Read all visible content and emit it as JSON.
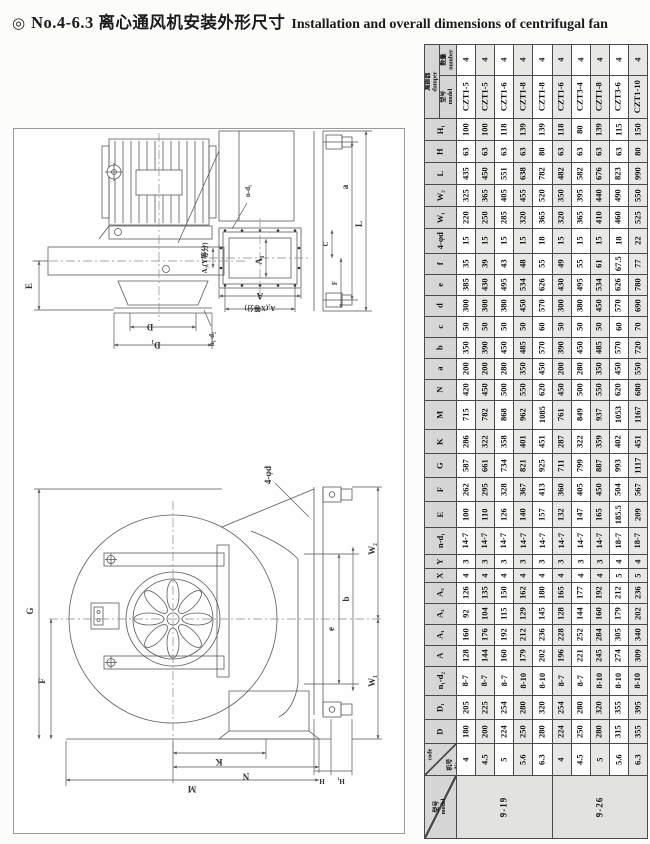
{
  "title": {
    "bullet": "◎",
    "zh": "No.4-6.3 离心通风机安装外形尺寸",
    "en": "Installation and overall dimensions of centrifugal fan"
  },
  "drawings": {
    "top": {
      "E": "E",
      "D": "D",
      "D1": "D₁",
      "n1d2": "n₁-d₂",
      "A1": "A₁",
      "A": "A",
      "A2x": "A₂(X等分)",
      "A3y": "A₃(Y等分)",
      "nd1": "n-d₁",
      "a": "a",
      "L": "L",
      "C": "C",
      "F": "F"
    },
    "bottom": {
      "phid": "4-φd",
      "G": "G",
      "F": "F",
      "W2": "W₂",
      "W1": "W₁",
      "e": "e",
      "b": "b",
      "K": "K",
      "N": "N",
      "M": "M",
      "H": "H",
      "H1": "H₁"
    }
  },
  "table": {
    "damper_group": "减振器\ndamper",
    "bands": [
      {
        "type": "damper-number",
        "label": "数量\nnumber",
        "h": 30,
        "cells": [
          "4",
          "4",
          "4",
          "4",
          "4",
          "4",
          "4",
          "4",
          "4",
          "4"
        ]
      },
      {
        "type": "damper-model",
        "label": "型号\nmodel",
        "h": 42,
        "cells": [
          "CZT1-5",
          "CZT1-5",
          "CZT1-6",
          "CZT1-8",
          "CZT1-8",
          "CZT1-6",
          "CZT3-4",
          "CZT1-8",
          "CZT3-6",
          "CZT1-10"
        ]
      },
      {
        "label": "H₁",
        "h": 21,
        "cells": [
          "100",
          "100",
          "118",
          "139",
          "139",
          "118",
          "80",
          "139",
          "115",
          "150"
        ]
      },
      {
        "label": "H",
        "h": 21,
        "cells": [
          "63",
          "63",
          "63",
          "63",
          "80",
          "63",
          "63",
          "63",
          "63",
          "80"
        ]
      },
      {
        "label": "L",
        "h": 21,
        "cells": [
          "435",
          "450",
          "551",
          "638",
          "782",
          "482",
          "582",
          "676",
          "823",
          "990"
        ]
      },
      {
        "label": "W₂",
        "h": 21,
        "cells": [
          "325",
          "365",
          "405",
          "455",
          "520",
          "350",
          "395",
          "440",
          "490",
          "550"
        ]
      },
      {
        "label": "W₁",
        "h": 21,
        "cells": [
          "220",
          "250",
          "285",
          "320",
          "365",
          "320",
          "365",
          "410",
          "460",
          "525"
        ]
      },
      {
        "label": "4-φd",
        "h": 24,
        "cells": [
          "15",
          "15",
          "15",
          "15",
          "18",
          "15",
          "15",
          "15",
          "18",
          "22"
        ]
      },
      {
        "label": "f",
        "h": 20,
        "cells": [
          "35",
          "39",
          "43",
          "48",
          "55",
          "49",
          "55",
          "61",
          "67.5",
          "77"
        ]
      },
      {
        "label": "e",
        "h": 20,
        "cells": [
          "385",
          "430",
          "495",
          "534",
          "626",
          "430",
          "495",
          "534",
          "626",
          "780"
        ]
      },
      {
        "label": "d",
        "h": 20,
        "cells": [
          "300",
          "300",
          "380",
          "450",
          "570",
          "300",
          "380",
          "450",
          "570",
          "690"
        ]
      },
      {
        "label": "c",
        "h": 20,
        "cells": [
          "50",
          "50",
          "50",
          "50",
          "60",
          "50",
          "50",
          "50",
          "60",
          "70"
        ]
      },
      {
        "label": "b",
        "h": 20,
        "cells": [
          "350",
          "390",
          "450",
          "485",
          "570",
          "390",
          "450",
          "485",
          "570",
          "720"
        ]
      },
      {
        "label": "a",
        "h": 20,
        "cells": [
          "200",
          "200",
          "280",
          "350",
          "450",
          "200",
          "280",
          "350",
          "450",
          "550"
        ]
      },
      {
        "label": "N",
        "h": 20,
        "cells": [
          "420",
          "450",
          "500",
          "550",
          "620",
          "450",
          "500",
          "550",
          "620",
          "680"
        ]
      },
      {
        "label": "M",
        "h": 28,
        "cells": [
          "715",
          "782",
          "868",
          "962",
          "1085",
          "761",
          "849",
          "937",
          "1053",
          "1167"
        ]
      },
      {
        "label": "K",
        "h": 23,
        "cells": [
          "286",
          "322",
          "358",
          "401",
          "451",
          "287",
          "322",
          "359",
          "402",
          "451"
        ]
      },
      {
        "label": "G",
        "h": 23,
        "cells": [
          "587",
          "661",
          "734",
          "821",
          "925",
          "711",
          "799",
          "887",
          "993",
          "1117"
        ]
      },
      {
        "label": "F",
        "h": 23,
        "cells": [
          "262",
          "295",
          "328",
          "367",
          "413",
          "360",
          "405",
          "450",
          "504",
          "567"
        ]
      },
      {
        "label": "E",
        "h": 25,
        "cells": [
          "100",
          "110",
          "126",
          "140",
          "157",
          "132",
          "147",
          "165",
          "185.5",
          "209"
        ]
      },
      {
        "label": "n-d₁",
        "h": 26,
        "cells": [
          "14-7",
          "14-7",
          "14-7",
          "14-7",
          "14-7",
          "14-7",
          "14-7",
          "14-7",
          "18-7",
          "18-7"
        ]
      },
      {
        "label": "Y",
        "h": 13,
        "cells": [
          "3",
          "3",
          "3",
          "3",
          "3",
          "3",
          "3",
          "3",
          "4",
          "4"
        ]
      },
      {
        "label": "X",
        "h": 13,
        "cells": [
          "4",
          "4",
          "4",
          "4",
          "4",
          "4",
          "4",
          "4",
          "5",
          "5"
        ]
      },
      {
        "label": "A₃",
        "h": 20,
        "cells": [
          "126",
          "135",
          "150",
          "162",
          "180",
          "165",
          "177",
          "192",
          "212",
          "236"
        ]
      },
      {
        "label": "A₂",
        "h": 20,
        "cells": [
          "92",
          "104",
          "115",
          "129",
          "145",
          "128",
          "144",
          "160",
          "179",
          "202"
        ]
      },
      {
        "label": "A₁",
        "h": 20,
        "cells": [
          "160",
          "176",
          "192",
          "212",
          "236",
          "228",
          "252",
          "284",
          "305",
          "340"
        ]
      },
      {
        "label": "A",
        "h": 20,
        "cells": [
          "128",
          "144",
          "160",
          "179",
          "202",
          "196",
          "221",
          "245",
          "274",
          "309"
        ]
      },
      {
        "label": "n₁-d₂",
        "h": 28,
        "cells": [
          "8-7",
          "8-7",
          "8-7",
          "8-10",
          "8-10",
          "8-7",
          "8-7",
          "8-10",
          "8-10",
          "8-10"
        ]
      },
      {
        "label": "D₁",
        "h": 23,
        "cells": [
          "205",
          "225",
          "254",
          "280",
          "320",
          "254",
          "280",
          "320",
          "355",
          "395"
        ]
      },
      {
        "label": "D",
        "h": 23,
        "cells": [
          "180",
          "200",
          "224",
          "250",
          "280",
          "224",
          "250",
          "280",
          "315",
          "355"
        ]
      },
      {
        "type": "code",
        "label": "代号\ncode",
        "label2": "机号\nNo.",
        "h": 31,
        "cells": [
          "4",
          "4.5",
          "5",
          "5.6",
          "6.3",
          "4",
          "4.5",
          "5",
          "5.6",
          "6.3"
        ]
      },
      {
        "type": "model-span",
        "label": "型号\nmodel",
        "h": 62,
        "merged": [
          {
            "text": "9-19",
            "span": 5
          },
          {
            "text": "9-26",
            "span": 5
          }
        ]
      }
    ]
  }
}
